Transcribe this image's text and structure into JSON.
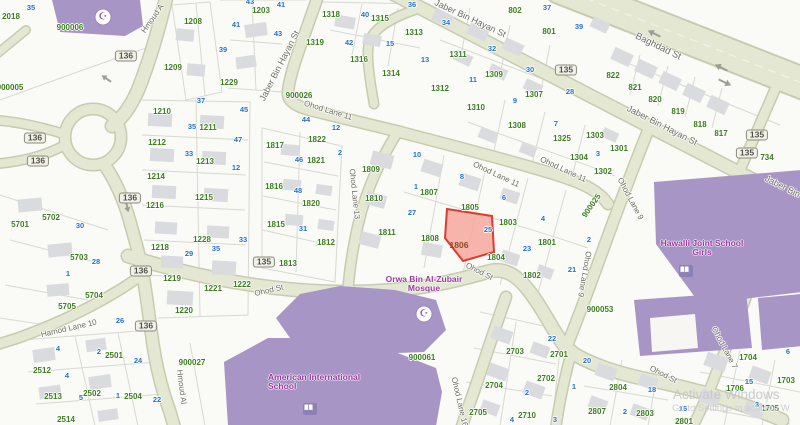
{
  "map": {
    "colors": {
      "background": "#fafaf6",
      "road_fill": "#e4e7d2",
      "road_casing": "#c7ccb0",
      "parcel_line": "#d9d9d3",
      "building_gray": "#dadbde",
      "building_purple": "#a795c6",
      "green": "#3b7d1f",
      "blue": "#2471cc",
      "street": "#6b6b60",
      "poi": "#9b3aa0",
      "selected_fill": "#f5a79e",
      "selected_stroke": "#e03a2e"
    },
    "selected_parcel": {
      "label": "1806",
      "x": 459,
      "y": 245,
      "house_number": "25"
    },
    "watermark": {
      "line1": "Activate Windows",
      "line2": "Go to Settings to activate W"
    },
    "route_shields": [
      {
        "t": "136",
        "x": 126,
        "y": 56
      },
      {
        "t": "136",
        "x": 35,
        "y": 138
      },
      {
        "t": "136",
        "x": 38,
        "y": 161
      },
      {
        "t": "136",
        "x": 130,
        "y": 198
      },
      {
        "t": "136",
        "x": 141,
        "y": 271
      },
      {
        "t": "136",
        "x": 146,
        "y": 326
      },
      {
        "t": "135",
        "x": 566,
        "y": 70
      },
      {
        "t": "135",
        "x": 757,
        "y": 135
      },
      {
        "t": "135",
        "x": 747,
        "y": 153
      },
      {
        "t": "135",
        "x": 264,
        "y": 262
      }
    ],
    "street_labels": [
      {
        "t": "Baghdad St",
        "x": 658,
        "y": 47,
        "r": 26,
        "s": 9.5
      },
      {
        "t": "Jaber Bin Hayan St",
        "x": 470,
        "y": 19,
        "r": 25,
        "s": 9
      },
      {
        "t": "Jaber Bin Hayan St",
        "x": 662,
        "y": 126,
        "r": 27,
        "s": 9
      },
      {
        "t": "Jaber Bin Hayan St",
        "x": 280,
        "y": 66,
        "r": -63,
        "s": 9
      },
      {
        "t": "Jaber Bin Hayan St",
        "x": 800,
        "y": 196,
        "r": 27,
        "s": 9
      },
      {
        "t": "Ohod Lane 11",
        "x": 328,
        "y": 111,
        "r": 17
      },
      {
        "t": "Ohod Lane 11",
        "x": 496,
        "y": 175,
        "r": 25
      },
      {
        "t": "Ohod Lane 11",
        "x": 563,
        "y": 170,
        "r": 25
      },
      {
        "t": "Ohod Lane 13",
        "x": 354,
        "y": 194,
        "r": 84
      },
      {
        "t": "Ohod Lane 9",
        "x": 630,
        "y": 199,
        "r": 62
      },
      {
        "t": "Ohod Lane 9",
        "x": 584,
        "y": 274,
        "r": 100
      },
      {
        "t": "Ohod St",
        "x": 269,
        "y": 291,
        "r": -13
      },
      {
        "t": "Ohod St",
        "x": 479,
        "y": 272,
        "r": 27
      },
      {
        "t": "Ohod St",
        "x": 663,
        "y": 375,
        "r": 27
      },
      {
        "t": "Hamod Lane 10",
        "x": 69,
        "y": 329,
        "r": -13
      },
      {
        "t": "Hmoud A",
        "x": 153,
        "y": 19,
        "r": -55
      },
      {
        "t": "Hmoud Al",
        "x": 181,
        "y": 387,
        "r": 83
      },
      {
        "t": "Ohod Lane 16",
        "x": 459,
        "y": 402,
        "r": 77
      },
      {
        "t": "Ohod Lane 7",
        "x": 724,
        "y": 348,
        "r": 62
      }
    ],
    "parcel_labels": [
      {
        "t": "900006",
        "x": 70,
        "y": 28
      },
      {
        "t": "2018",
        "x": 11,
        "y": 17
      },
      {
        "t": "900005",
        "x": 10,
        "y": 88
      },
      {
        "t": "1208",
        "x": 193,
        "y": 22
      },
      {
        "t": "1209",
        "x": 173,
        "y": 68
      },
      {
        "t": "1203",
        "x": 261,
        "y": 11
      },
      {
        "t": "1229",
        "x": 229,
        "y": 83
      },
      {
        "t": "1318",
        "x": 331,
        "y": 15
      },
      {
        "t": "1315",
        "x": 380,
        "y": 19
      },
      {
        "t": "1319",
        "x": 315,
        "y": 43
      },
      {
        "t": "1316",
        "x": 359,
        "y": 60
      },
      {
        "t": "1314",
        "x": 391,
        "y": 74
      },
      {
        "t": "1313",
        "x": 414,
        "y": 33
      },
      {
        "t": "1311",
        "x": 458,
        "y": 55
      },
      {
        "t": "1309",
        "x": 494,
        "y": 75
      },
      {
        "t": "1312",
        "x": 440,
        "y": 89
      },
      {
        "t": "1307",
        "x": 534,
        "y": 95
      },
      {
        "t": "1310",
        "x": 476,
        "y": 108
      },
      {
        "t": "1308",
        "x": 517,
        "y": 126
      },
      {
        "t": "802",
        "x": 515,
        "y": 11
      },
      {
        "t": "801",
        "x": 549,
        "y": 32
      },
      {
        "t": "822",
        "x": 613,
        "y": 76
      },
      {
        "t": "821",
        "x": 635,
        "y": 88
      },
      {
        "t": "820",
        "x": 655,
        "y": 100
      },
      {
        "t": "819",
        "x": 678,
        "y": 112
      },
      {
        "t": "818",
        "x": 700,
        "y": 125
      },
      {
        "t": "817",
        "x": 721,
        "y": 134
      },
      {
        "t": "734",
        "x": 767,
        "y": 158
      },
      {
        "t": "1325",
        "x": 562,
        "y": 139
      },
      {
        "t": "1303",
        "x": 595,
        "y": 136
      },
      {
        "t": "1301",
        "x": 619,
        "y": 149
      },
      {
        "t": "1304",
        "x": 579,
        "y": 158
      },
      {
        "t": "1302",
        "x": 603,
        "y": 172
      },
      {
        "t": "900026",
        "x": 299,
        "y": 96
      },
      {
        "t": "900025",
        "x": 592,
        "y": 206,
        "r": -55
      },
      {
        "t": "1210",
        "x": 162,
        "y": 112
      },
      {
        "t": "1211",
        "x": 208,
        "y": 128
      },
      {
        "t": "1212",
        "x": 157,
        "y": 143
      },
      {
        "t": "1213",
        "x": 205,
        "y": 162
      },
      {
        "t": "1214",
        "x": 156,
        "y": 177
      },
      {
        "t": "1215",
        "x": 204,
        "y": 198
      },
      {
        "t": "1216",
        "x": 155,
        "y": 206
      },
      {
        "t": "1817",
        "x": 275,
        "y": 146
      },
      {
        "t": "1816",
        "x": 274,
        "y": 187
      },
      {
        "t": "1822",
        "x": 317,
        "y": 140
      },
      {
        "t": "1821",
        "x": 316,
        "y": 161
      },
      {
        "t": "1809",
        "x": 371,
        "y": 170
      },
      {
        "t": "1810",
        "x": 374,
        "y": 199
      },
      {
        "t": "1820",
        "x": 311,
        "y": 204
      },
      {
        "t": "1807",
        "x": 429,
        "y": 193
      },
      {
        "t": "1805",
        "x": 470,
        "y": 208
      },
      {
        "t": "1808",
        "x": 430,
        "y": 239
      },
      {
        "t": "1811",
        "x": 387,
        "y": 233
      },
      {
        "t": "1812",
        "x": 326,
        "y": 243
      },
      {
        "t": "1813",
        "x": 288,
        "y": 264
      },
      {
        "t": "1815",
        "x": 276,
        "y": 225
      },
      {
        "t": "1228",
        "x": 202,
        "y": 240
      },
      {
        "t": "1218",
        "x": 160,
        "y": 248
      },
      {
        "t": "1219",
        "x": 172,
        "y": 279
      },
      {
        "t": "1221",
        "x": 213,
        "y": 289
      },
      {
        "t": "1222",
        "x": 242,
        "y": 285
      },
      {
        "t": "1220",
        "x": 184,
        "y": 311
      },
      {
        "t": "1803",
        "x": 508,
        "y": 223
      },
      {
        "t": "1804",
        "x": 496,
        "y": 258
      },
      {
        "t": "1801",
        "x": 547,
        "y": 243
      },
      {
        "t": "1802",
        "x": 532,
        "y": 276
      },
      {
        "t": "5701",
        "x": 20,
        "y": 225
      },
      {
        "t": "5702",
        "x": 51,
        "y": 218
      },
      {
        "t": "5703",
        "x": 79,
        "y": 258
      },
      {
        "t": "5704",
        "x": 94,
        "y": 296
      },
      {
        "t": "5705",
        "x": 67,
        "y": 307
      },
      {
        "t": "2501",
        "x": 114,
        "y": 356
      },
      {
        "t": "2512",
        "x": 42,
        "y": 371
      },
      {
        "t": "2513",
        "x": 53,
        "y": 397
      },
      {
        "t": "2502",
        "x": 92,
        "y": 394
      },
      {
        "t": "2504",
        "x": 133,
        "y": 397
      },
      {
        "t": "2514",
        "x": 66,
        "y": 420
      },
      {
        "t": "900027",
        "x": 192,
        "y": 363
      },
      {
        "t": "900061",
        "x": 422,
        "y": 358
      },
      {
        "t": "900053",
        "x": 600,
        "y": 310
      },
      {
        "t": "2703",
        "x": 515,
        "y": 352
      },
      {
        "t": "2701",
        "x": 559,
        "y": 355
      },
      {
        "t": "2702",
        "x": 546,
        "y": 379
      },
      {
        "t": "2704",
        "x": 494,
        "y": 386
      },
      {
        "t": "2705",
        "x": 478,
        "y": 413
      },
      {
        "t": "2710",
        "x": 527,
        "y": 416
      },
      {
        "t": "2804",
        "x": 618,
        "y": 388
      },
      {
        "t": "2807",
        "x": 597,
        "y": 412
      },
      {
        "t": "2803",
        "x": 645,
        "y": 414
      },
      {
        "t": "2801",
        "x": 684,
        "y": 422
      },
      {
        "t": "1704",
        "x": 748,
        "y": 358
      },
      {
        "t": "1703",
        "x": 786,
        "y": 381
      },
      {
        "t": "1706",
        "x": 735,
        "y": 389
      },
      {
        "t": "1705",
        "x": 770,
        "y": 409
      }
    ],
    "house_numbers": [
      {
        "t": "35",
        "x": 31,
        "y": 8
      },
      {
        "t": "43",
        "x": 250,
        "y": 2
      },
      {
        "t": "41",
        "x": 281,
        "y": 5
      },
      {
        "t": "41",
        "x": 236,
        "y": 25
      },
      {
        "t": "43",
        "x": 278,
        "y": 34
      },
      {
        "t": "39",
        "x": 223,
        "y": 50
      },
      {
        "t": "40",
        "x": 365,
        "y": 15
      },
      {
        "t": "42",
        "x": 349,
        "y": 43
      },
      {
        "t": "15",
        "x": 390,
        "y": 44
      },
      {
        "t": "36",
        "x": 412,
        "y": 5
      },
      {
        "t": "34",
        "x": 446,
        "y": 23
      },
      {
        "t": "13",
        "x": 425,
        "y": 60
      },
      {
        "t": "32",
        "x": 492,
        "y": 49
      },
      {
        "t": "37",
        "x": 547,
        "y": 8
      },
      {
        "t": "39",
        "x": 579,
        "y": 27
      },
      {
        "t": "30",
        "x": 530,
        "y": 70
      },
      {
        "t": "11",
        "x": 473,
        "y": 80
      },
      {
        "t": "28",
        "x": 570,
        "y": 92
      },
      {
        "t": "9",
        "x": 515,
        "y": 101
      },
      {
        "t": "7",
        "x": 556,
        "y": 124
      },
      {
        "t": "3",
        "x": 598,
        "y": 154
      },
      {
        "t": "37",
        "x": 201,
        "y": 101
      },
      {
        "t": "45",
        "x": 244,
        "y": 110
      },
      {
        "t": "35",
        "x": 192,
        "y": 127
      },
      {
        "t": "47",
        "x": 238,
        "y": 140
      },
      {
        "t": "33",
        "x": 189,
        "y": 154
      },
      {
        "t": "12",
        "x": 236,
        "y": 168
      },
      {
        "t": "44",
        "x": 306,
        "y": 120
      },
      {
        "t": "12",
        "x": 336,
        "y": 128
      },
      {
        "t": "2",
        "x": 340,
        "y": 153
      },
      {
        "t": "10",
        "x": 417,
        "y": 155
      },
      {
        "t": "1",
        "x": 416,
        "y": 187
      },
      {
        "t": "8",
        "x": 462,
        "y": 177
      },
      {
        "t": "6",
        "x": 504,
        "y": 198
      },
      {
        "t": "46",
        "x": 299,
        "y": 160
      },
      {
        "t": "48",
        "x": 298,
        "y": 191
      },
      {
        "t": "27",
        "x": 412,
        "y": 213
      },
      {
        "t": "25",
        "x": 488,
        "y": 230
      },
      {
        "t": "23",
        "x": 527,
        "y": 249
      },
      {
        "t": "21",
        "x": 572,
        "y": 270
      },
      {
        "t": "4",
        "x": 543,
        "y": 219
      },
      {
        "t": "2",
        "x": 589,
        "y": 240
      },
      {
        "t": "31",
        "x": 303,
        "y": 229
      },
      {
        "t": "33",
        "x": 243,
        "y": 240
      },
      {
        "t": "29",
        "x": 189,
        "y": 254
      },
      {
        "t": "35",
        "x": 216,
        "y": 249
      },
      {
        "t": "30",
        "x": 80,
        "y": 226
      },
      {
        "t": "28",
        "x": 96,
        "y": 262
      },
      {
        "t": "1",
        "x": 68,
        "y": 274
      },
      {
        "t": "26",
        "x": 120,
        "y": 321
      },
      {
        "t": "4",
        "x": 58,
        "y": 349
      },
      {
        "t": "2",
        "x": 99,
        "y": 352
      },
      {
        "t": "24",
        "x": 138,
        "y": 361
      },
      {
        "t": "4",
        "x": 67,
        "y": 376
      },
      {
        "t": "5",
        "x": 81,
        "y": 398
      },
      {
        "t": "1",
        "x": 118,
        "y": 396
      },
      {
        "t": "22",
        "x": 157,
        "y": 400
      },
      {
        "t": "22",
        "x": 552,
        "y": 339
      },
      {
        "t": "20",
        "x": 587,
        "y": 361
      },
      {
        "t": "1",
        "x": 574,
        "y": 387
      },
      {
        "t": "2",
        "x": 527,
        "y": 393
      },
      {
        "t": "4",
        "x": 512,
        "y": 420
      },
      {
        "t": "3",
        "x": 555,
        "y": 420
      },
      {
        "t": "18",
        "x": 652,
        "y": 390
      },
      {
        "t": "2",
        "x": 625,
        "y": 412
      },
      {
        "t": "16",
        "x": 683,
        "y": 409
      },
      {
        "t": "6",
        "x": 788,
        "y": 352
      },
      {
        "t": "15",
        "x": 749,
        "y": 382
      },
      {
        "t": "3",
        "x": 757,
        "y": 405
      }
    ],
    "poi_labels": [
      {
        "t": "Orwa Bin Al-Zubair\nMosque",
        "x": 424,
        "y": 284,
        "align": "center"
      },
      {
        "t": "American International\nSchool",
        "x": 268,
        "y": 382,
        "align": "left"
      },
      {
        "t": "Hawalli Joint School Girls",
        "x": 702,
        "y": 248,
        "align": "center"
      }
    ]
  }
}
